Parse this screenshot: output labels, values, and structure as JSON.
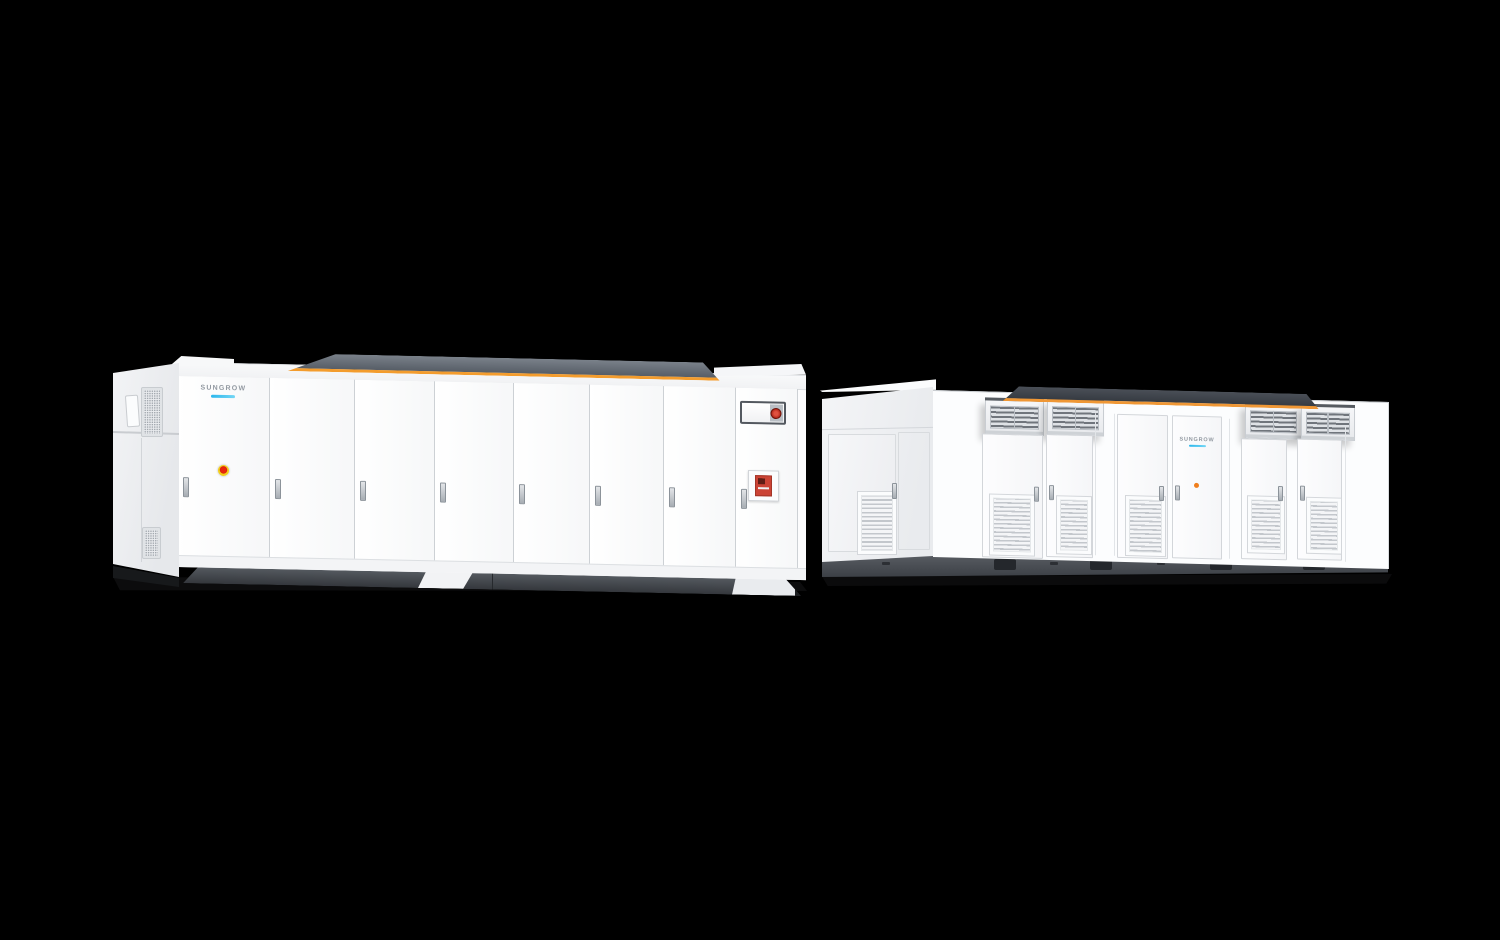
{
  "page": {
    "background_color": "#000000",
    "description": "3D product render of two Sungrow utility-scale energy storage units on a black background"
  },
  "brand": {
    "wordmark": "SUNGROW",
    "underline_color": "#2fbcee"
  },
  "palette": {
    "panel_white": "#fcfdfe",
    "side_panel_gray": "#eef0f3",
    "roof_gray_left": "#5f666f",
    "roof_gray_right": "#42474e",
    "accent_orange": "#f39c2d",
    "skid_dark_gray": "#44484e",
    "shadow_black": "#0b0b0c",
    "estop_red": "#da2208",
    "estop_yellow": "#f2cf1c",
    "fire_panel_red": "#cb4335",
    "indicator_orange": "#f07f1e"
  },
  "units": {
    "battery_container": {
      "label": "Battery energy storage container",
      "position": "left",
      "door_count": 8,
      "features": [
        "sungrow-wordmark",
        "emergency-stop-button",
        "hmi-display",
        "fire-alarm-panel",
        "door-handles",
        "side-vent-grilles",
        "orange-roof-stripe",
        "skid-base"
      ]
    },
    "mv_station": {
      "label": "MV power conversion station",
      "position": "right",
      "door_count": 6,
      "features": [
        "roof-vent-hoods",
        "door-louver-vents",
        "sungrow-wordmark",
        "indicator-dot",
        "side-vent-grille",
        "orange-roof-stripe",
        "skid-base",
        "forklift-pockets"
      ]
    }
  }
}
